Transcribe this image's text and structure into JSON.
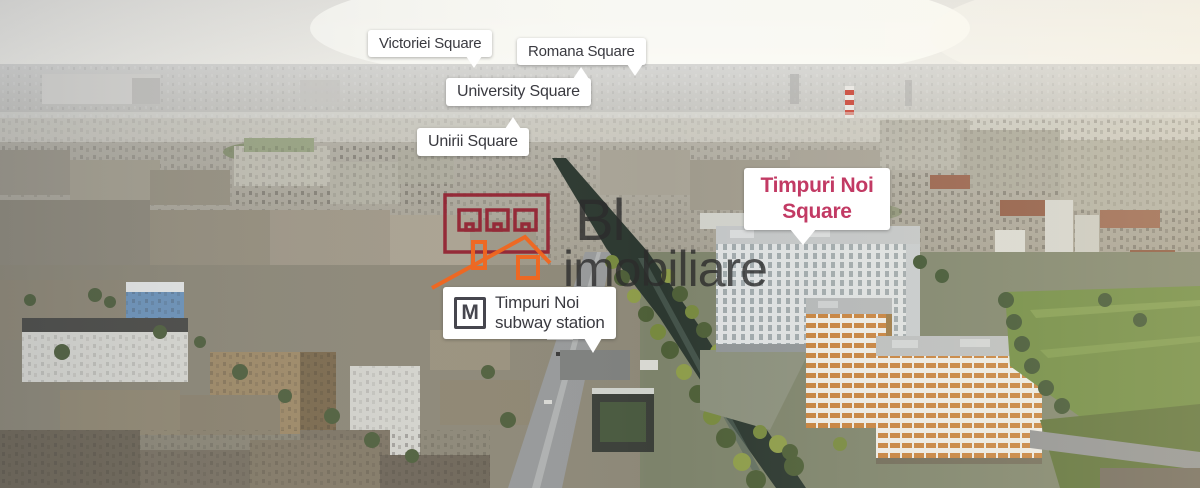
{
  "scene": {
    "description": "Aerial panorama of Bucharest city with location callouts over the Timpuri Noi area"
  },
  "callouts": {
    "victoriei": {
      "label": "Victoriei Square"
    },
    "romana": {
      "label": "Romana Square"
    },
    "university": {
      "label": "University Square"
    },
    "unirii": {
      "label": "Unirii Square"
    },
    "timpuri_noi": {
      "line1": "Timpuri Noi",
      "line2": "Square"
    },
    "subway": {
      "metro_letter": "M",
      "line1": "Timpuri Noi",
      "line2": "subway station"
    }
  },
  "watermark": {
    "line1": "Bl",
    "line2": "imobiliare"
  },
  "colors": {
    "callout_bg": "#ffffff",
    "callout_text": "#3a3a40",
    "accent_pink": "#c23a64",
    "metro_icon": "#46464e",
    "watermark_building_red": "#942534",
    "watermark_house_orange": "#f2671f",
    "watermark_text": "#2c2c2c"
  }
}
